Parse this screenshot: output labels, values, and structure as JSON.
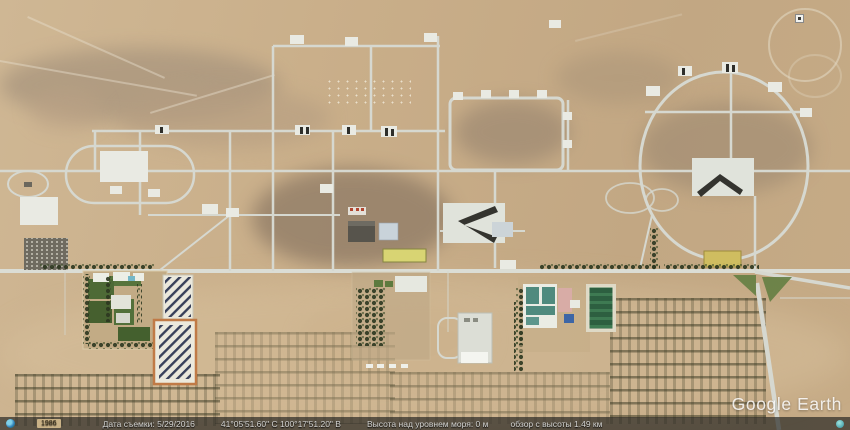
{
  "app": {
    "watermark": "Google Earth"
  },
  "status_bar": {
    "badge": "1986",
    "imagery_date": "Дата съемки: 5/29/2016",
    "coordinates": "41°05'51.60\" С   100°17'51.20\" В",
    "elevation": "Высота над уровнем моря: 0 м",
    "eye_altitude": "обзор с высоты 1.49 км"
  },
  "icons": [
    "globe-icon",
    "info-dot-icon",
    "map-marker-icon"
  ],
  "colors": {
    "desert_base": "#c9ae89",
    "road": "#d6d8d0",
    "pad_white": "#e9eae3",
    "vegetation_dark": "#2c3820",
    "lawn_green": "#4e6a36",
    "sports_field_green": "#2d5f40",
    "solar_stripe_navy": "#38405a",
    "solar_wall_orange": "#c07a46",
    "teal_roof": "#4f8a7e",
    "pink_roof": "#d8aca6",
    "pool_blue": "#3d66a6",
    "yellow_building": "#d8d473",
    "status_bar_bg": "#232321",
    "watermark_white": "#ffffff"
  }
}
